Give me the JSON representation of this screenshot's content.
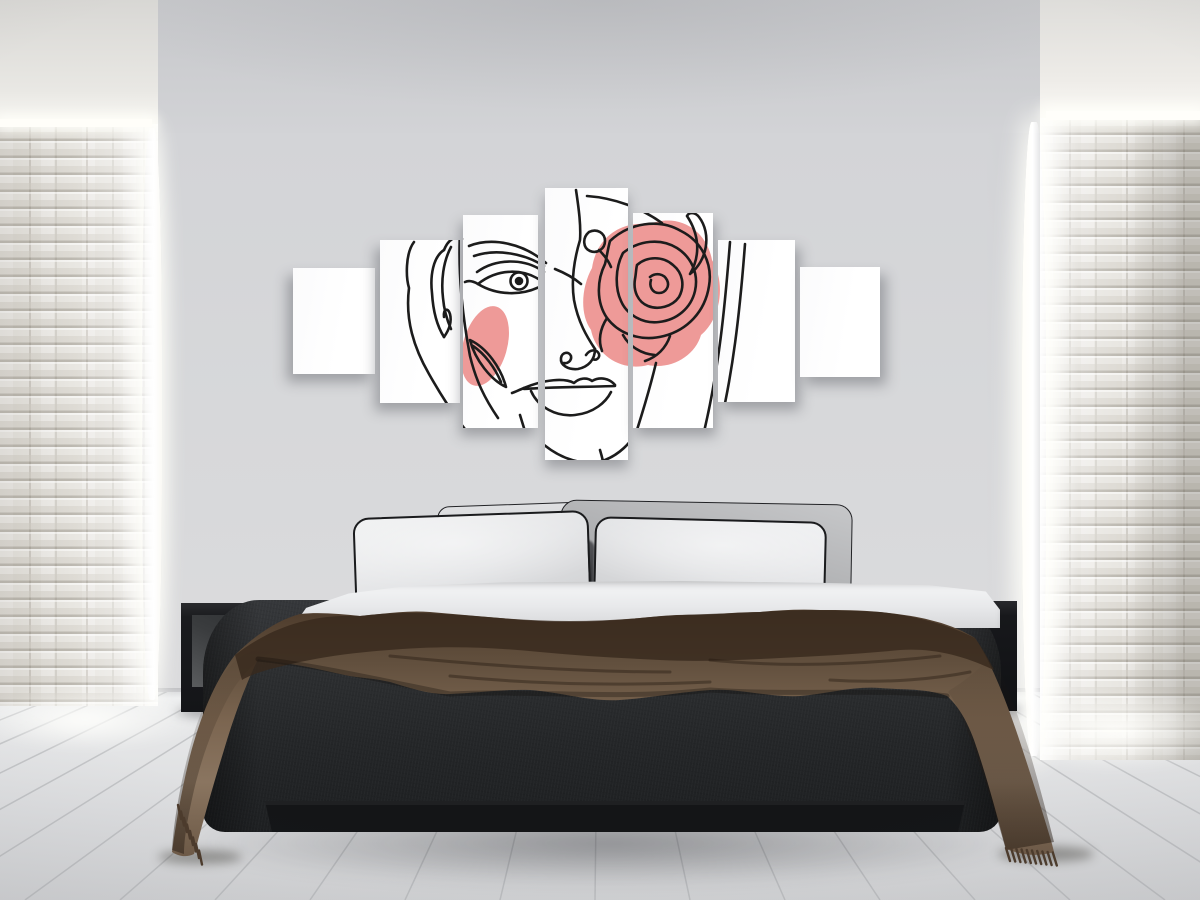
{
  "scene": {
    "type": "bedroom-interior-photo",
    "description": "Modern bedroom with a 7-piece canvas wall art of a one-line woman face with pink rose, black platform bed, brown throw blanket, black open-cube nightstands, white stacked-stone side walls with cove lighting, whitewashed plank floor",
    "width": 1200,
    "height": 900
  },
  "colors": {
    "accent_pink": "#ee9a98",
    "line_black": "#1c1c1c",
    "wall_gray": "#d6d7d9",
    "ceiling_gray": "#cbccCF",
    "brick_white": "#e9e7e2",
    "floor_light": "#e4e5e7",
    "bed_charcoal": "#2a2c2e",
    "blanket_brown": "#7b6550",
    "blanket_dark": "#3a2b1f",
    "pillow_white": "#e9eaec",
    "pillow_gray": "#b0b1b3",
    "nightstand_black": "#141518",
    "canvas_white": "#fdfdfd"
  },
  "artwork": {
    "panel_count": 7,
    "subject": "single-line woman face with rose over right eye and pink accents",
    "container": {
      "left": 293,
      "top": 188,
      "width": 587,
      "height": 272
    },
    "panels": [
      {
        "x": 0,
        "y": 80,
        "w": 82,
        "h": 106
      },
      {
        "x": 87,
        "y": 52,
        "w": 80,
        "h": 163
      },
      {
        "x": 170,
        "y": 27,
        "w": 75,
        "h": 213
      },
      {
        "x": 252,
        "y": 0,
        "w": 83,
        "h": 272
      },
      {
        "x": 340,
        "y": 25,
        "w": 80,
        "h": 215
      },
      {
        "x": 425,
        "y": 52,
        "w": 77,
        "h": 162
      },
      {
        "x": 507,
        "y": 79,
        "w": 80,
        "h": 110
      }
    ],
    "shadow_x": [
      -6,
      -5,
      -3,
      0,
      3,
      5,
      6
    ],
    "pink_paths": [
      "M299,80 C303,52 325,33 356,36 C388,24 414,44 419,72 C433,95 428,130 408,147 C402,168 378,182 355,177 C328,184 303,167 298,142 C286,125 289,98 299,80 Z"
    ],
    "pink_ellipse": {
      "cx": 192,
      "cy": 158,
      "rx": 22,
      "ry": 41,
      "rotate": 16
    },
    "stroke_paths": [
      "M121,54 C112,66 113,90 116,100 C112,132 121,160 136,186 C149,209 163,231 180,251 C188,261 198,267 208,270",
      "M167,44 C165,84 169,126 177,168 C183,193 192,211 205,230",
      "M151,62 C140,69 137,88 139,105 C140,122 144,138 151,149",
      "M158,59 C150,74 148,93 150,110 C151,122 154,132 158,141",
      "M151,62 C155,52 162,47 169,51",
      "M151,149 C156,142 159,134 157,126 C155,119 150,121 151,129",
      "M176,58 C199,49 230,55 253,75",
      "M181,68 C204,60 232,66 251,78",
      "M262,81 C272,85 281,90 288,96",
      "M184,84 C203,70 232,70 251,84",
      "M185,96 C205,80 231,80 250,94",
      "M185,96 C203,107 229,109 250,97",
      "M185,96 C180,93 176,92 172,94",
      "M283,2 C286,22 288,38 287,52 C281,72 278,92 281,112 C285,134 294,149 302,161",
      "M302,161 C302,172 295,179 285,181 C275,182 267,177 268,170 C269,164 276,163 278,168 C279,173 274,176 271,175",
      "M293,167 C297,161 304,161 306,166 C307,170 303,173 300,171",
      "M231,200 C252,191 272,190 281,195 C286,190 294,189 299,193 C308,188 317,191 322,197",
      "M231,201 C256,199 292,199 322,198",
      "M238,203 C245,219 263,229 282,227 C301,225 313,214 318,204",
      "M231,200 C226,202 222,204 219,205",
      "M250,256 C268,271 291,279 312,272 C327,266 337,255 342,246",
      "M227,227 C233,247 239,265 246,283",
      "M363,175 C357,200 350,223 343,245",
      "M307,262 C310,272 312,282 313,290",
      "M317,53 C336,35 366,30 388,43 C408,53 420,75 416,98 C412,124 394,142 371,148 C348,154 326,146 314,130 C303,114 304,92 312,76 C314,68 315,60 317,53",
      "M330,65 C346,52 368,50 384,60 C398,69 406,85 402,103 C398,120 384,132 366,134 C350,136 334,127 328,113 C322,100 322,80 330,65",
      "M344,77 C354,68 370,68 380,77 C390,85 392,98 386,109 C379,119 365,122 355,118 C345,114 340,103 342,91 C343,86 343,81 344,77",
      "M357,89 C363,84 371,86 374,92 C377,98 373,105 366,105 C359,105 356,98 358,92",
      "M330,147 C336,158 348,166 362,167",
      "M377,148 C373,160 364,169 352,173",
      "M314,130 C307,141 305,152 309,163",
      "M296,44 C304,40 312,45 312,53 C312,61 304,66 297,63 C290,60 289,50 296,44 M306,62 C312,68 316,74 318,79",
      "M394,28 C406,46 408,67 397,86 C414,73 419,46 406,29 C402,24 396,24 394,28",
      "M294,8 C322,10 348,20 369,35",
      "M437,54 C432,118 426,182 410,248",
      "M452,56 C447,122 440,188 424,250",
      "M177,152 C194,160 208,180 213,199 C198,192 182,172 177,152 Z",
      "M180,158 C192,166 202,180 208,194"
    ],
    "circles": [
      {
        "cx": 226,
        "cy": 93,
        "r": 8.5,
        "fill": "none"
      },
      {
        "cx": 226,
        "cy": 93,
        "r": 3,
        "fill": "line"
      }
    ],
    "stroke_width": 2.6
  },
  "floor": {
    "vanishing_point": {
      "x": 600,
      "y": 480
    },
    "top": 692,
    "seam_spacing": 95,
    "seam_color": "#aaacaf"
  },
  "bedding": {
    "blanket_paths": [
      {
        "d": "M85,95 C105,75 128,60 150,54 C170,52 190,54 210,56 C233,54 256,50 280,52 C303,54 326,56 350,58 C373,60 396,62 420,62 C443,62 466,60 490,58 C510,56 530,54 550,55 C570,54 590,52 610,52 C630,50 650,49 670,50 C690,50 710,50 730,52 C748,54 765,56 780,60 C797,64 812,70 825,78 C840,100 856,140 868,176 C880,212 892,250 902,284 L904,292 C888,297 872,295 856,289 C846,252 836,214 824,180 C815,156 806,144 797,136 C775,128 752,130 730,128 C703,126 677,134 650,136 C620,138 590,128 560,130 C530,132 500,138 470,140 C440,142 410,132 380,130 C353,129 326,133 300,134 C280,135 260,128 240,122 C223,118 206,118 190,114 C172,110 155,106 140,104 C128,102 118,101 108,99 C96,124 84,156 74,190 C64,222 54,258 46,288 L44,294 C36,298 28,296 22,292 C26,262 32,228 40,196 C50,158 64,122 85,95 Z",
        "fill": "url(#gBlanket)"
      },
      {
        "d": "M85,95 C120,68 160,54 210,56 C256,50 303,54 350,58 C396,62 443,62 490,58 C530,54 570,54 610,52 C650,49 690,50 730,52 C765,56 797,64 825,78 C832,88 838,98 844,110 C810,94 780,88 750,90 C710,94 670,96 630,98 C590,100 550,102 510,100 C470,98 430,96 390,92 C350,88 310,86 270,88 C230,90 190,94 160,100 C130,106 105,112 92,120 Z",
        "fill": "#38291d",
        "opacity": 0.82
      },
      {
        "d": "M800,130 C820,118 834,104 842,95 C856,120 870,160 882,200 C890,228 898,258 904,282 L856,290 C844,248 832,208 820,178 C812,158 806,142 798,132 Z",
        "fill": "url(#gRightDrape)"
      },
      {
        "d": "M136,86 C112,94 92,112 78,138 C64,164 52,196 44,230 C38,256 34,278 34,294 L22,290 C24,256 32,216 42,180 C52,144 68,114 90,97 C104,88 122,83 136,86 Z",
        "fill": "url(#gLeftDrape)"
      },
      {
        "d": "M240,96 C320,104 420,112 520,112 M560,100 C640,108 720,104 790,96 M300,116 C380,124 470,126 560,122 M680,120 C740,124 790,118 820,112",
        "stroke": "rgba(32,22,13,.38)",
        "stroke_width": 3
      },
      {
        "d": "M108,99 C160,104 240,122 300,134 C380,130 470,140 560,130 C650,136 730,128 797,136",
        "stroke": "rgba(12,9,6,.30)",
        "stroke_width": 5
      }
    ],
    "tassels": [
      {
        "x": 28,
        "y": 245,
        "dx": 3.0,
        "dy": 6.5,
        "count": 8,
        "len": 14,
        "lean": 3
      },
      {
        "x": 856,
        "y": 288,
        "dx": 5.2,
        "dy": 0.5,
        "count": 10,
        "len": 13,
        "lean": 4
      }
    ],
    "tassel_color": "#4c3b2c"
  },
  "furniture": {
    "nightstands": 2,
    "pillows": 4,
    "style": "black open-cube nightstands, platform bed"
  }
}
